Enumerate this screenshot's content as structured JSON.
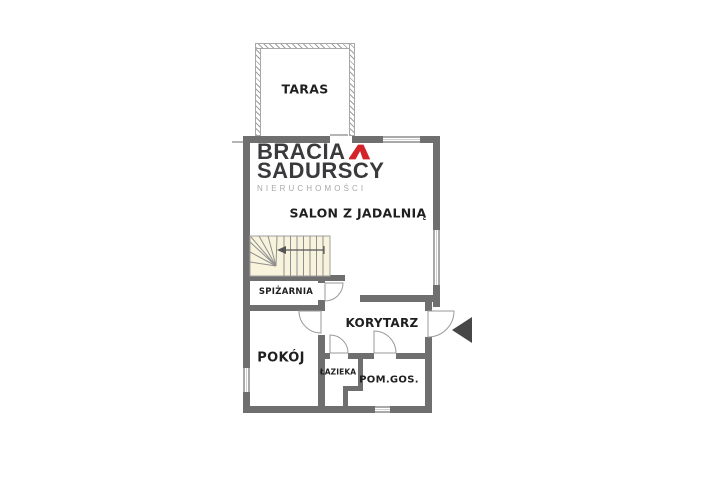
{
  "branding": {
    "name_line1": "BRACIA",
    "name_line2": "SADURSCY",
    "tagline": "NIERUCHOMOŚCI"
  },
  "rooms": {
    "taras": "TARAS",
    "salon": "SALON Z JADALNIĄ",
    "spizarnia": "SPIŻARNIA",
    "pokoj": "POKÓJ",
    "korytarz": "KORYTARZ",
    "lazienka": "ŁAZIEKA",
    "pomgos": "POM.GOS."
  },
  "colors": {
    "wall": "#6f6f6f",
    "wall_light": "#a9a9a9",
    "line": "#b5b5b5",
    "stairs_fill": "#f7f3dd",
    "text": "#1f1f1f",
    "logo_dark": "#3a3a3c",
    "logo_gray": "#a8a8a8",
    "logo_red": "#d2232a",
    "arrow": "#474747"
  }
}
